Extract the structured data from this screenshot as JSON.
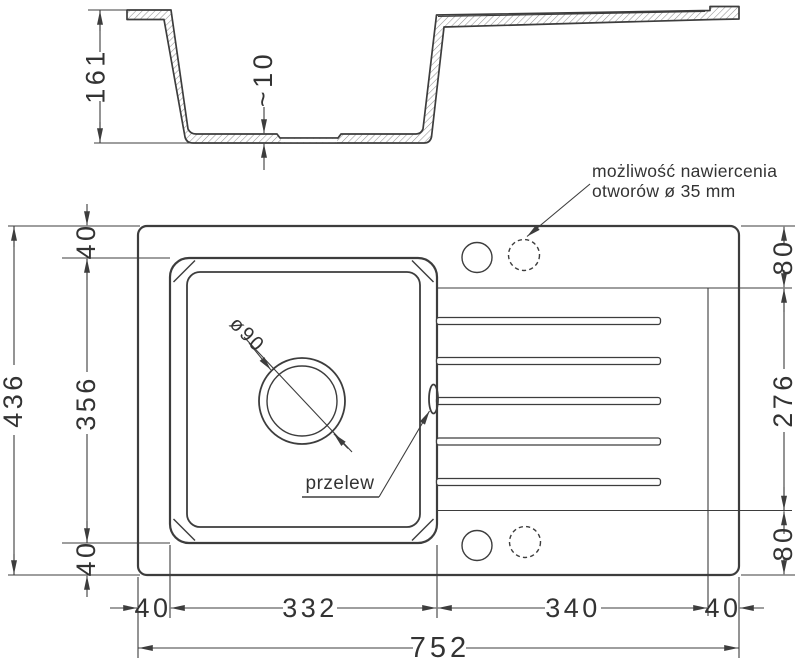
{
  "title": "Kitchen sink technical drawing",
  "colors": {
    "line": "#3d3d3d",
    "hatch": "#909090",
    "background": "#ffffff"
  },
  "section_view": {
    "depth_dim": "161",
    "bottom_thickness_dim": "~10"
  },
  "plan_view": {
    "drill_note": {
      "line1": "możliwość nawiercenia",
      "line2": "otworów ø 35 mm"
    },
    "overflow_label": "przelew",
    "drain_diameter_label": "ø90",
    "dims_left": {
      "total_height": "436",
      "top_margin": "40",
      "bowl_height": "356",
      "bottom_margin": "40"
    },
    "dims_right": {
      "top_offset": "80",
      "drainer_height": "276",
      "bottom_offset": "80"
    },
    "dims_bottom": {
      "left_margin": "40",
      "bowl_width": "332",
      "drainer_width": "340",
      "right_margin": "40",
      "total_width": "752"
    }
  }
}
